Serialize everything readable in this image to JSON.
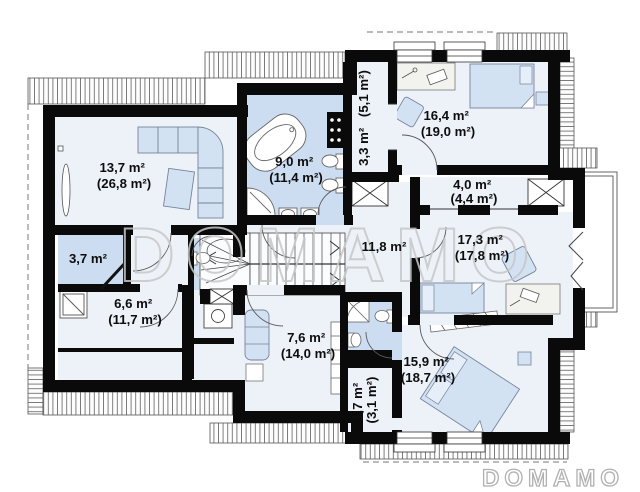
{
  "watermark": {
    "text": "DOMAMO"
  },
  "logo": {
    "text": "DOMAMO"
  },
  "rooms": [
    {
      "id": "living",
      "area": "13,7 m²",
      "total": "(26,8 m²)"
    },
    {
      "id": "bathroom",
      "area": "9,0 m²",
      "total": "(11,4 m²)"
    },
    {
      "id": "corridor33",
      "area": "3,3 m²",
      "total": "(5,1 m²)"
    },
    {
      "id": "bedroom164",
      "area": "16,4 m²",
      "total": "(19,0 m²)"
    },
    {
      "id": "wardrobe40",
      "area": "4,0 m²",
      "total": "(4,4 m²)"
    },
    {
      "id": "hall118",
      "area": "11,8 m²",
      "total": ""
    },
    {
      "id": "room173",
      "area": "17,3 m²",
      "total": "(17,8 m²)"
    },
    {
      "id": "storage37",
      "area": "3,7 m²",
      "total": ""
    },
    {
      "id": "room66",
      "area": "6,6 m²",
      "total": "(11,7 m²)"
    },
    {
      "id": "room76",
      "area": "7,6 m²",
      "total": "(14,0 m²)"
    },
    {
      "id": "bedroom159",
      "area": "15,9 m²",
      "total": "(18,7 m²)"
    },
    {
      "id": "room17",
      "area": "1,7 m²",
      "total": "(3,1 m²)"
    }
  ]
}
